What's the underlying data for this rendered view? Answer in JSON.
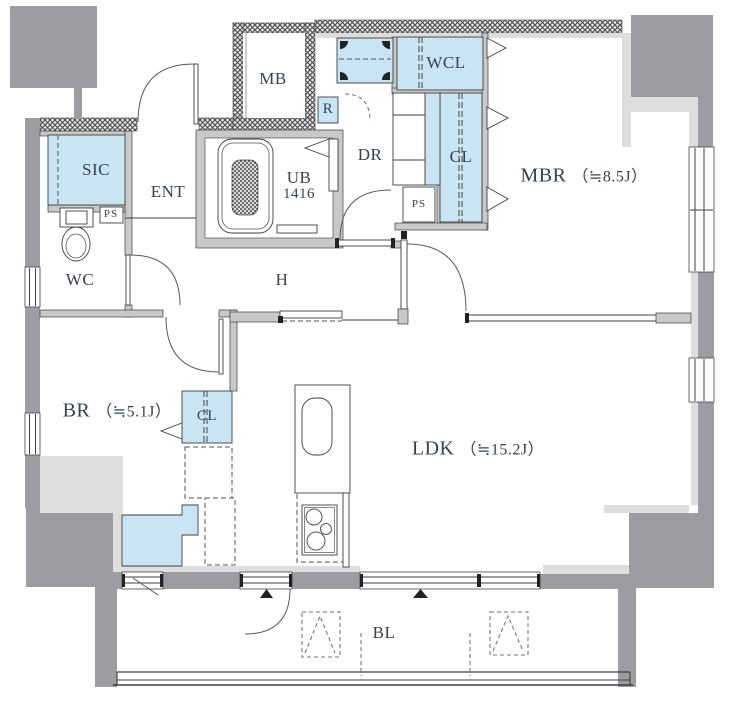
{
  "plan": {
    "type": "apartment-floor-plan",
    "rooms": {
      "mbr": {
        "name": "MBR",
        "area": "（≒8.5J）"
      },
      "ldk": {
        "name": "LDK",
        "area": "（≒15.2J）"
      },
      "br": {
        "name": "BR",
        "area": "（≒5.1J）"
      },
      "wcl": {
        "name": "WCL"
      },
      "cl_mbr": {
        "name": "CL"
      },
      "cl_br": {
        "name": "CL"
      },
      "sic": {
        "name": "SIC"
      },
      "ent": {
        "name": "ENT"
      },
      "wc": {
        "name": "WC"
      },
      "ub": {
        "name": "UB",
        "size": "1416"
      },
      "dr": {
        "name": "DR"
      },
      "mb": {
        "name": "MB"
      },
      "hall": {
        "name": "H"
      },
      "balcony": {
        "name": "BL"
      },
      "refrigerator_space": {
        "name": "R"
      },
      "ps_dressing": {
        "name": "PS"
      },
      "ps_wc": {
        "name": "PS"
      }
    },
    "colors": {
      "wall_dark": "#9b9da0",
      "wall_gray": "#c9c9c9",
      "wall_liner": "#dedede",
      "storage_blue": "#c9e5f4",
      "text": "#39414f",
      "line": "#3f3f3f"
    }
  }
}
